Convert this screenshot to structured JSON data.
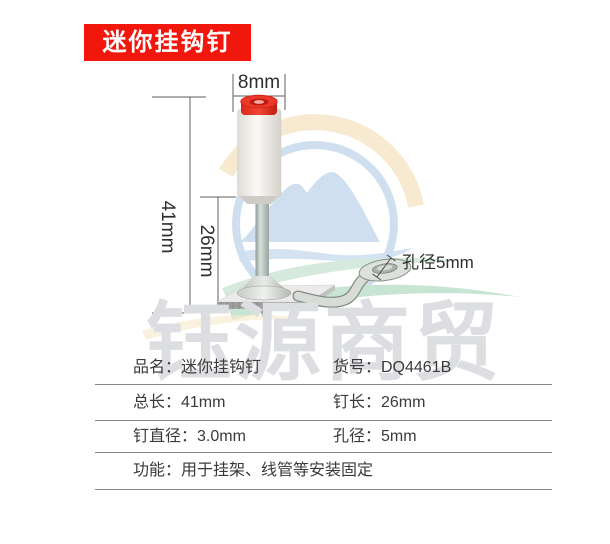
{
  "badge": {
    "label": "迷你挂钩钉"
  },
  "watermark": {
    "text": "钰源商贸"
  },
  "annotations": {
    "cap_diameter": "8mm",
    "total_length": "41mm",
    "pin_length": "26mm",
    "hole_label": "孔径5mm"
  },
  "spec_table": {
    "rows": [
      {
        "cells": [
          "品名：迷你挂钩钉",
          "货号：DQ4461B"
        ]
      },
      {
        "cells": [
          "总长：41mm",
          "钉长：26mm"
        ]
      },
      {
        "cells": [
          "钉直径：3.0mm",
          "孔径：5mm"
        ]
      },
      {
        "cells": [
          "功能：用于挂架、线管等安装固定"
        ]
      }
    ]
  },
  "colors": {
    "badge_red": "#f2170c",
    "cap_red": "#ec3829",
    "cap_ring_dark": "#bc1b10",
    "cap_hole_pink": "#f2a89e",
    "logo_cream": "#f7e9ce",
    "logo_blue": "#cfdfef",
    "logo_green_light": "#d6e9dd",
    "logo_green": "#c8e4d2",
    "dimension_line": "#5f5f5f",
    "annotation_text": "#2e2e2e",
    "table_line": "#858585",
    "watermark_gray": "#dcdee1"
  }
}
